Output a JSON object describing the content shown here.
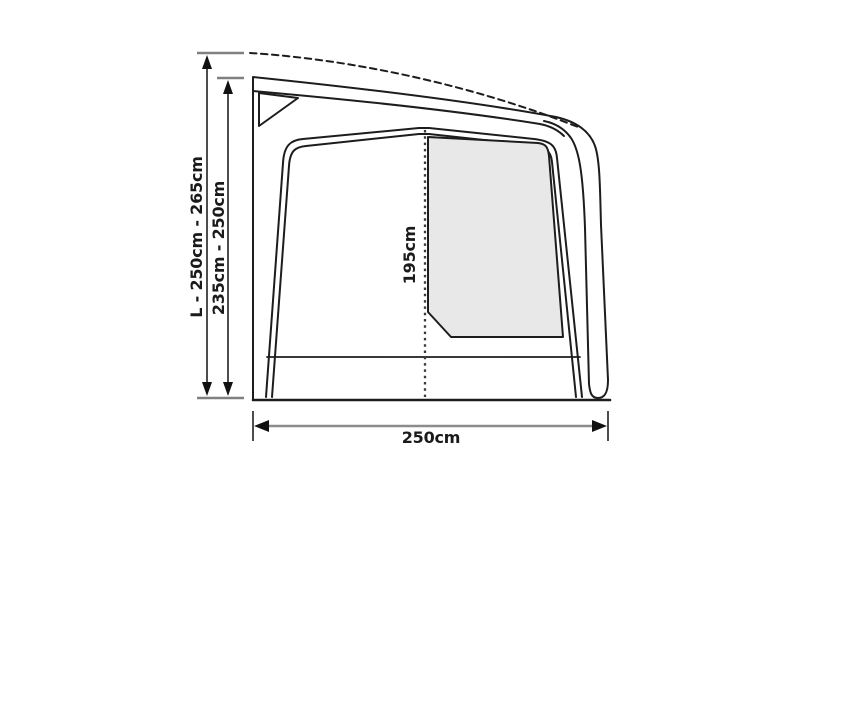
{
  "diagram": {
    "labels": {
      "height_range_outer": "L - 250cm - 265cm",
      "height_range_inner": "235cm - 250cm",
      "door_height": "195cm",
      "depth": "250cm"
    },
    "colors": {
      "outline": "#1d1d1d",
      "window_fill": "#e8e8e8",
      "dotted_line": "#3a3a3a",
      "dimension_shaft": "#4d4d4d",
      "dimension_shaft_light": "#8c8c8c",
      "tick": "#808080",
      "arrowhead": "#111111",
      "text": "#1a1a1a",
      "background": "#ffffff"
    }
  }
}
